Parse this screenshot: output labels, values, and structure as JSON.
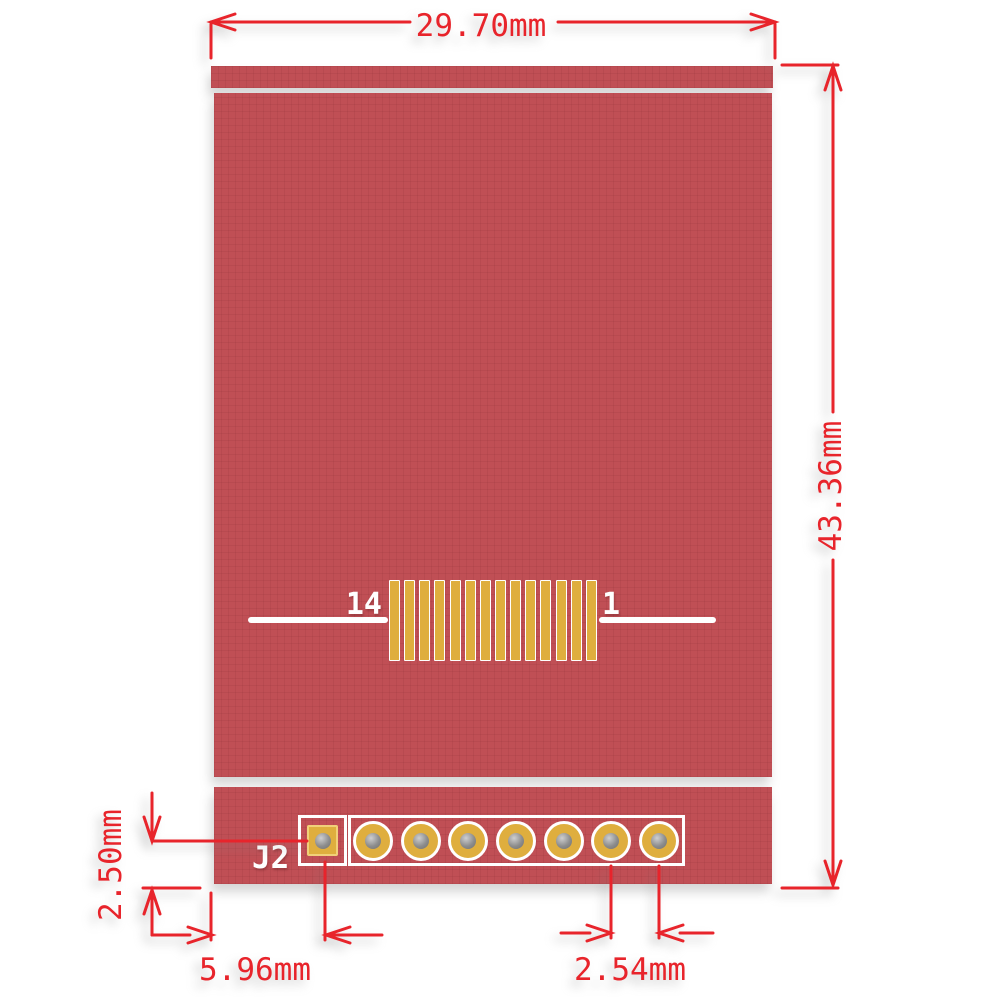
{
  "diagram": {
    "type": "PCB dimension drawing (display module rear view)",
    "dimensions": {
      "board_width": "29.70mm",
      "board_height": "43.36mm",
      "pad_center_to_board_bottom": "2.50mm",
      "board_edge_to_pin1": "5.96mm",
      "pad_pitch": "2.54mm"
    },
    "silkscreen": {
      "connector_left_pin_label": "14",
      "connector_right_pin_label": "1",
      "header_label": "J2"
    },
    "connector": {
      "pin_count": 14
    },
    "header": {
      "square_pad_count": 1,
      "round_pad_count": 7
    },
    "colors": {
      "board_red": "#c04f55",
      "pad_gold": "#dfae3e",
      "dimension_red": "#e8242b",
      "silkscreen_white": "#ffffff",
      "hole_gray": "#8d8d8d",
      "background": "#ffffff"
    }
  }
}
